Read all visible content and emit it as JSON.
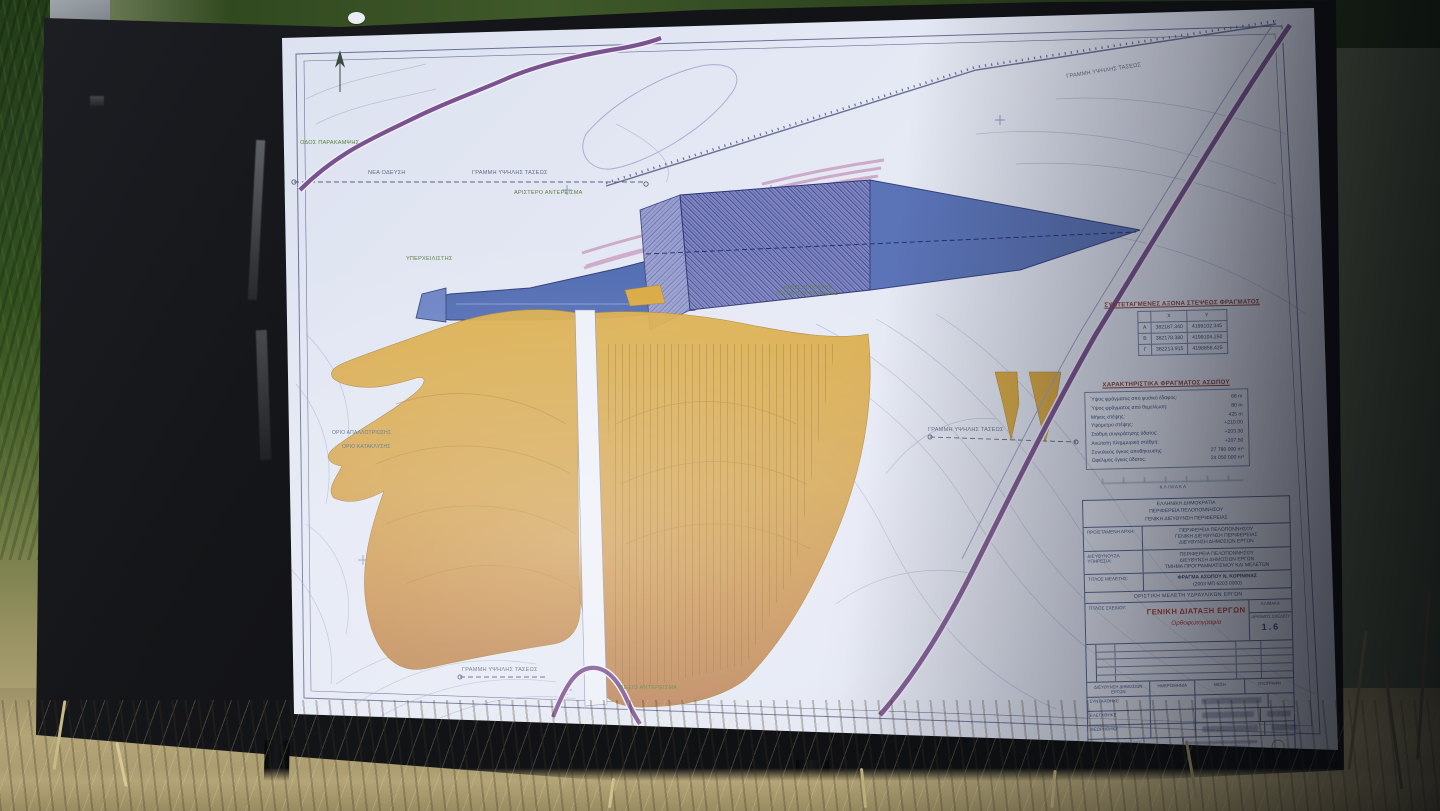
{
  "map": {
    "labels": [
      {
        "text": "ΟΔΟΣ ΠΑΡΑΚΑΜΨΗΣ",
        "color": "green"
      },
      {
        "text": "ΑΡΙΣΤΕΡΟ ΑΝΤΕΡΕΙΣΜΑ",
        "color": "green"
      },
      {
        "text": "ΥΠΕΡΧΕΙΛΙΣΤΗΣ",
        "color": "green"
      },
      {
        "text": "ΧΩΡΟΣ ΑΠΟΘΕΣΗΣ ΠΡΟΪΟΝΤΩΝ ΕΚΣΚΑΦΗΣ",
        "color": "green"
      },
      {
        "text": "ΟΡΙΟ ΑΠΑΛΛΟΤΡΙΩΣΗΣ",
        "color": "teal"
      },
      {
        "text": "ΟΡΙΟ ΚΑΤΑΚΛΥΣΗΣ",
        "color": "teal"
      },
      {
        "text": "ΝΕΑ ΟΔΕΥΣΗ",
        "color": "gray"
      },
      {
        "text": "ΓΡΑΜΜΗ ΥΨΗΛΗΣ ΤΑΣΕΩΣ",
        "color": "gray"
      },
      {
        "text": "ΓΡΑΜΜΗ ΥΨΗΛΗΣ ΤΑΣΕΩΣ",
        "color": "gray"
      },
      {
        "text": "ΓΡΑΜΜΗ ΥΨΗΛΗΣ ΤΑΣΕΩΣ",
        "color": "gray"
      },
      {
        "text": "ΓΡΑΜΜΗ ΥΨΗΛΗΣ ΤΑΣΕΩΣ",
        "color": "gray"
      },
      {
        "text": "ΔΕΞΙΟ ΑΝΤΕΡΕΙΣΜΑ",
        "color": "green"
      }
    ]
  },
  "coords_table": {
    "title": "ΣΥΝΤΕΤΑΓΜΕΝΕΣ ΑΞΟΝΑ ΣΤΕΨΕΩΣ ΦΡΑΓΜΑΤΟΣ",
    "col_x": "X",
    "col_y": "Y",
    "rows": [
      {
        "pt": "Α",
        "x": "382187.340",
        "y": "4199102.345"
      },
      {
        "pt": "Β",
        "x": "382178.380",
        "y": "4199104.250"
      },
      {
        "pt": "Γ",
        "x": "382213.915",
        "y": "4198858.425"
      }
    ]
  },
  "characteristics": {
    "title": "ΧΑΡΑΚΤΗΡΙΣΤΙΚΑ ΦΡΑΓΜΑΤΟΣ ΑΣΩΠΟΥ",
    "rows": [
      {
        "label": "Ύψος φράγματος από φυσικό έδαφος:",
        "value": "68 m"
      },
      {
        "label": "Ύψος φράγματος από θεμελίωση:",
        "value": "80 m"
      },
      {
        "label": "Μήκος στέψης:",
        "value": "425 m"
      },
      {
        "label": "Υψόμετρο στέψης:",
        "value": "+210.00"
      },
      {
        "label": "Στάθμη συγκράτησης ύδατος:",
        "value": "+203.30"
      },
      {
        "label": "Ανώτατη πλημμυρική στάθμη:",
        "value": "+207.50"
      },
      {
        "label": "Συνολικός όγκος αποθήκευσης:",
        "value": "27 780 000 m³"
      },
      {
        "label": "Ωφέλιμος όγκος ύδατος:",
        "value": "24 050 000 m³"
      }
    ]
  },
  "scale_caption": "ΚΛΙΜΑΚΑ",
  "title_block": {
    "authority_lines": [
      "ΕΛΛΗΝΙΚΗ ΔΗΜΟΚΡΑΤΙΑ",
      "ΠΕΡΙΦΕΡΕΙΑ ΠΕΛΟΠΟΝΝΗΣΟΥ",
      "ΓΕΝΙΚΗ ΔΙΕΥΘΥΝΣΗ ΠΕΡΙΦΕΡΕΙΑΣ"
    ],
    "rows": [
      {
        "label": "ΠΡΟΪΣΤΑΜΕΝΗ ΑΡΧΗ:",
        "lines": [
          "ΠΕΡΙΦΕΡΕΙΑ ΠΕΛΟΠΟΝΝΗΣΟΥ",
          "ΓΕΝΙΚΗ ΔΙΕΥΘΥΝΣΗ ΠΕΡΙΦΕΡΕΙΑΣ",
          "ΔΙΕΥΘΥΝΣΗ ΔΗΜΟΣΙΩΝ ΕΡΓΩΝ"
        ]
      },
      {
        "label": "ΔΙΕΥΘΥΝΟΥΣΑ ΥΠΗΡΕΣΙΑ:",
        "lines": [
          "ΠΕΡΙΦΕΡΕΙΑ ΠΕΛΟΠΟΝΝΗΣΟΥ",
          "ΔΙΕΥΘΥΝΣΗ ΔΗΜΟΣΙΩΝ ΕΡΓΩΝ",
          "ΤΜΗΜΑ ΠΡΟΓΡΑΜΜΑΤΙΣΜΟΥ ΚΑΙ ΜΕΛΕΤΩΝ"
        ]
      },
      {
        "label": "ΤΙΤΛΟΣ ΜΕΛΕΤΗΣ:",
        "lines": [
          "ΦΡΑΓΜΑ ΑΣΩΠΟΥ Ν. ΚΟΡΙΝΘΙΑΣ",
          "(2003 ΜΠ 6203 0000)",
          ""
        ]
      }
    ],
    "study_phase": "ΟΡΙΣΤΙΚΗ ΜΕΛΕΤΗ ΥΔΡΑΥΛΙΚΩΝ ΕΡΓΩΝ",
    "drawing_title_label": "ΤΙΤΛΟΣ ΣΧΕΔΙΟΥ:",
    "drawing_title": "ΓΕΝΙΚΗ ΔΙΑΤΑΞΗ ΕΡΓΩΝ",
    "drawing_subtitle": "Ορθοφωτογραφία",
    "scale_label": "ΚΛΙΜΑΚΑ",
    "number_label": "ΑΡΙΘΜΟΣ ΣΧΕΔΙΟΥ",
    "drawing_number": "1.6",
    "dept_header": "ΔΙΕΥΘΥΝΣΗ ΔΗΜΟΣΙΩΝ ΕΡΓΩΝ",
    "approval_cols": [
      "ΗΜΕΡΟΜΗΝΙΑ",
      "ΘΕΣΗ",
      "ΥΠΟΓΡΑΦΗ"
    ],
    "approval_rows": [
      "ΣΥΝΤΑΧΘΗΚΕ",
      "ΕΛΕΓΧΘΗΚΕ",
      "ΘΕΩΡΗΘΗΚΕ"
    ],
    "designers_lines": [
      "ΑΝΑΔΟΧΟΙ ΜΕΛΕΤΗΤΕΣ:",
      "ΣΥΜΠΡΑΤΤΟΝΤΑ ΓΡΑΦΕΙΑ ΜΕΛΕΤΩΝ",
      "ΥΔΡΑΥΛΙΚΩΝ ΕΡΓΩΝ",
      "ΒΑΣΙΚΟΙ ΜΕΛΕΤΗΤΕΣ"
    ]
  }
}
